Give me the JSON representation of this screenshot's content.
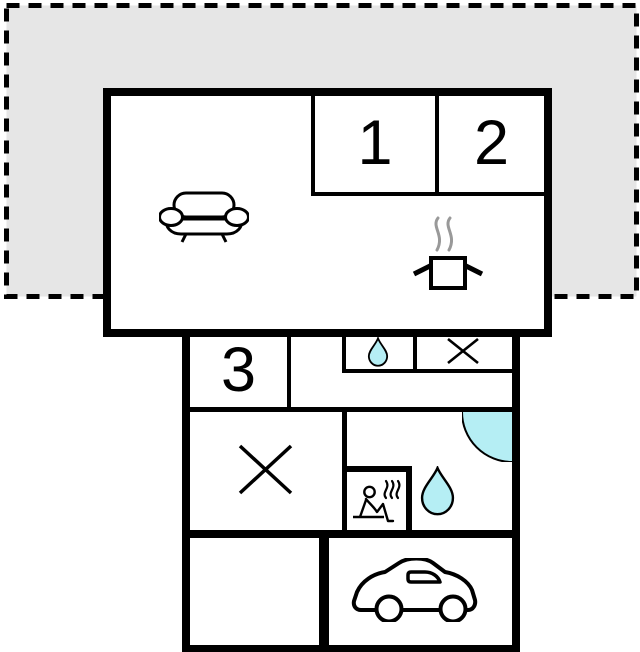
{
  "plan": {
    "room_labels": {
      "room1": "1",
      "room2": "2",
      "room3": "3"
    },
    "icons": {
      "sofa-icon": "sofa / living area",
      "cooking-pot-icon": "stove with steam / kitchen",
      "water-drop-small-icon": "water drop / washbasin",
      "x-mark-small-icon": "crossed-out cell",
      "x-mark-large-icon": "crossed-out room",
      "shower-icon": "corner shower",
      "sauna-icon": "person in sauna with steam",
      "water-drop-large-icon": "water drop / bathroom",
      "car-icon": "car / garage parking"
    },
    "colors": {
      "terrace_fill": "#e6e6e6",
      "line": "#000000",
      "water": "#b5eef4",
      "steam": "#999999"
    }
  }
}
